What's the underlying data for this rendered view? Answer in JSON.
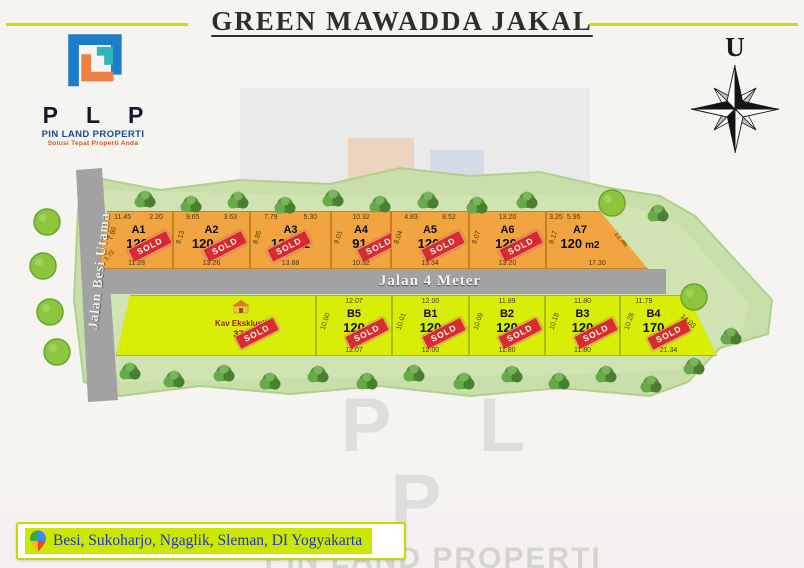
{
  "header": {
    "title": "GREEN MAWADDA JAKAL"
  },
  "logo": {
    "letters": "P L P",
    "company": "PIN LAND PROPERTI",
    "tagline": "Solusi Tepat Properti Anda"
  },
  "compass": {
    "north_label": "U"
  },
  "plan": {
    "sold_label": "SOLD",
    "roads": {
      "vertical": "Jalan Besi Utama",
      "horizontal": "Jalan 4 Meter"
    },
    "lots_a": [
      {
        "name": "A1",
        "area": "120",
        "unit": "",
        "sold": true,
        "dim_top1": "11.45",
        "dim_top2": "2.20",
        "dim_bottom": "11.28",
        "dim_side": "7.60",
        "dim_corner": "1.73"
      },
      {
        "name": "A2",
        "area": "120",
        "unit": "m2",
        "sold": true,
        "dim_top1": "9.65",
        "dim_top2": "3.63",
        "dim_bottom": "13.26",
        "dim_side": "9.13"
      },
      {
        "name": "A3",
        "area": "120",
        "unit": "m2",
        "sold": true,
        "dim_top1": "7.79",
        "dim_top2": "5.30",
        "dim_bottom": "13.88",
        "dim_side": "8.95"
      },
      {
        "name": "A4",
        "area": "91",
        "unit": "",
        "sold": true,
        "dim_top1": "10.32",
        "dim_bottom": "10.32",
        "dim_side": "9.01"
      },
      {
        "name": "A5",
        "area": "120",
        "unit": "",
        "sold": true,
        "dim_top1": "4.83",
        "dim_top2": "8.52",
        "dim_bottom": "13.34",
        "dim_side": "8.04"
      },
      {
        "name": "A6",
        "area": "120",
        "unit": "",
        "sold": true,
        "dim_top1": "13.20",
        "dim_bottom": "13.20",
        "dim_side": "9.07"
      },
      {
        "name": "A7",
        "area": "120",
        "unit": "m2",
        "sold": false,
        "dim_top1": "3.25",
        "dim_top2": "5.95",
        "dim_bottom": "17.30",
        "dim_side": "9.17",
        "dim_slant": "12.46"
      }
    ],
    "lots_b": [
      {
        "name": "Kav Eksklusif",
        "area": "371",
        "sold": true
      },
      {
        "name": "B5",
        "area": "120",
        "sold": true,
        "dim_top1": "12.07",
        "dim_bottom": "12.07",
        "dim_side": "10.00"
      },
      {
        "name": "B1",
        "area": "120",
        "sold": true,
        "dim_top1": "12.00",
        "dim_bottom": "12.00",
        "dim_side": "10.01"
      },
      {
        "name": "B2",
        "area": "120",
        "sold": true,
        "dim_top1": "11.89",
        "dim_bottom": "11.80",
        "dim_side": "10.09"
      },
      {
        "name": "B3",
        "area": "120",
        "sold": true,
        "dim_top1": "11.80",
        "dim_bottom": "11.80",
        "dim_side": "10.18"
      },
      {
        "name": "B4",
        "area": "170",
        "sold": true,
        "dim_top1": "11.79",
        "dim_bottom": "21.34",
        "dim_side": "10.28",
        "dim_slant": "14.03"
      }
    ]
  },
  "watermark": {
    "letters": "P L P",
    "company": "PIN LAND PROPERTI",
    "tagline": "Solusi Tepat Properti Anda"
  },
  "footer": {
    "location": "Besi, Sukoharjo, Ngaglik, Sleman, DI Yogyakarta"
  }
}
